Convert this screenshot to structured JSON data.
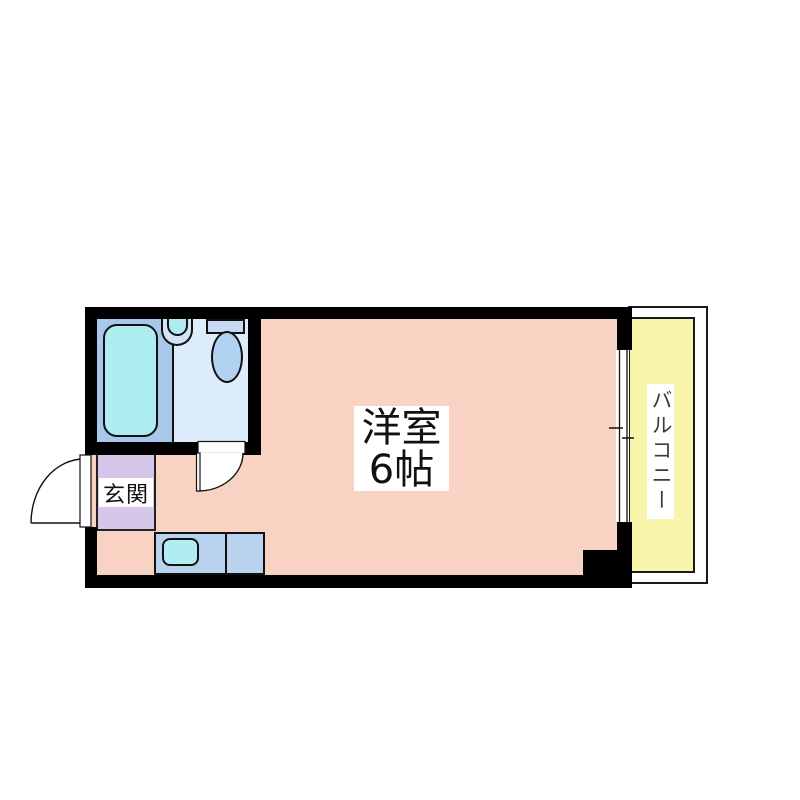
{
  "floorplan": {
    "labels": {
      "main_room_name": "洋室",
      "main_room_size": "6帖",
      "entrance": "玄関",
      "balcony": "バルコニー"
    },
    "colors": {
      "wall": "#000000",
      "room_pink": "#f8d2c2",
      "entrance_lavender": "#d6c6ea",
      "balcony_yellow": "#f8f4aa",
      "bath_section_blue": "#a8c8ea",
      "toilet_section_blue": "#dcecfa",
      "bathtub_cyan": "#aeeef2",
      "toilet_tank_blue": "#c8daf2",
      "toilet_bowl_blue": "#b2d2f2",
      "kitchen_counter_blue": "#b9d2ee",
      "sink_cyan": "#b0ecf2",
      "outline": "#111111"
    },
    "fixtures": {
      "bathtub": "bathtub-icon",
      "washbasin": "washbasin-icon",
      "toilet": "toilet-icon",
      "kitchen_sink": "kitchen-sink-icon",
      "entrance_door": "swing-door-icon",
      "bathroom_door": "swing-door-icon",
      "window": "sliding-window-icon"
    }
  }
}
